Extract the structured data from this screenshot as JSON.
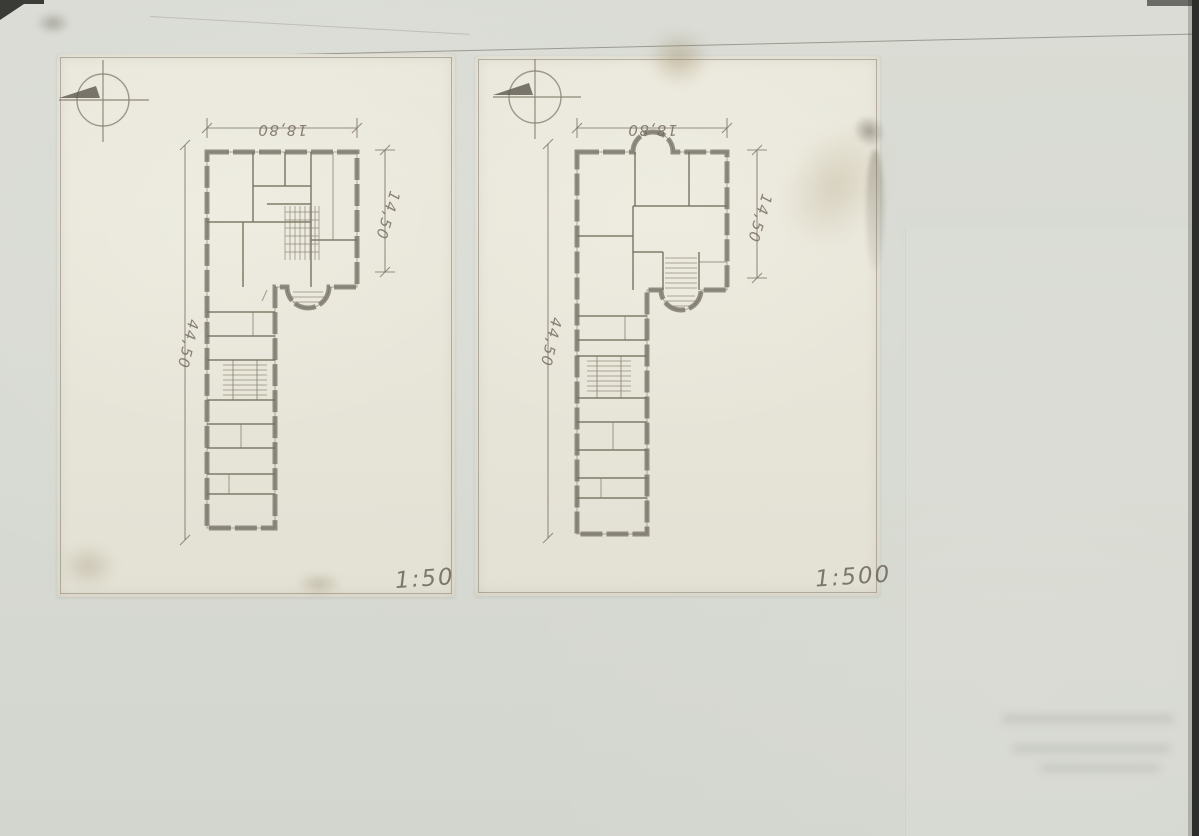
{
  "document_kind": "scanned architectural floor plan drawing, two prints pasted on aged paper",
  "colors": {
    "paper_bg": "#d9dcd4",
    "sheet_bg": "#eae8dc",
    "ink": "#6e6a5e",
    "stain": "#927c54"
  },
  "sheets": [
    {
      "name": "left-plan-sheet",
      "scale_label": "1:50",
      "dimensions": {
        "top_width": "18,80",
        "right_depth": "14,50",
        "left_length": "44,50"
      },
      "icons": {
        "compass": "north-compass-icon"
      }
    },
    {
      "name": "right-plan-sheet",
      "scale_label": "1:500",
      "dimensions": {
        "top_width": "18,80",
        "right_depth": "14,50",
        "left_length": "44,50"
      },
      "icons": {
        "compass": "north-compass-icon"
      }
    }
  ]
}
